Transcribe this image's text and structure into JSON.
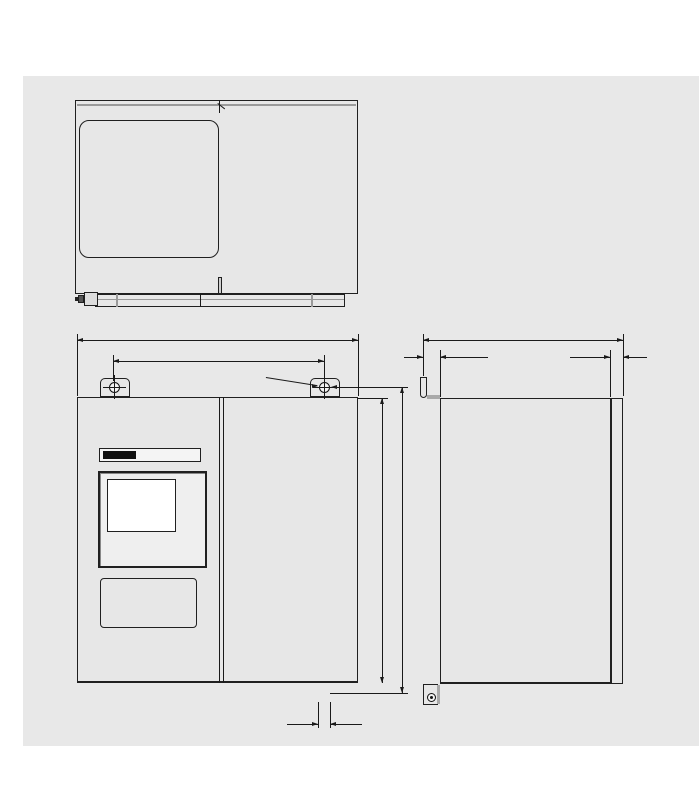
{
  "page": {
    "heading": "尺寸",
    "caption": "OXYMAT 6，现场式尺寸，单位为mm"
  },
  "colors": {
    "panel_bg": "#e8e8e8",
    "line": "#1a1a1a",
    "body_fill": "#e7e7e7"
  },
  "top_view": {
    "ordinate_dims_top": [
      {
        "label": "0"
      },
      {
        "label": "20"
      },
      {
        "label": "42"
      },
      {
        "label": "77"
      },
      {
        "label": "112"
      },
      {
        "label": "148"
      },
      {
        "label": "184"
      },
      {
        "label": "250"
      },
      {
        "label": "259"
      },
      {
        "label": "394"
      },
      {
        "label": "418"
      }
    ],
    "ordinate_dims_right": [
      {
        "label": "271"
      },
      {
        "label": "253"
      },
      {
        "label": "237"
      },
      {
        "label": "201"
      },
      {
        "label": "127"
      },
      {
        "label": "65"
      },
      {
        "label": "58"
      },
      {
        "label": "0"
      }
    ],
    "gland_callout": "5"
  },
  "front_view": {
    "width_dim": "438",
    "mount_span_dim": "328",
    "mount_hole_dim": "ø 14",
    "body_height_dim": "444",
    "total_height_dim": "480",
    "gland_offset_dim": "14",
    "nameplate": {
      "brand": "SIEMENS",
      "model": "OXYMAT 6"
    }
  },
  "side_view": {
    "depth_dim": "311",
    "bracket_offset_dim": "26.5",
    "door_edge_dim": "20"
  }
}
